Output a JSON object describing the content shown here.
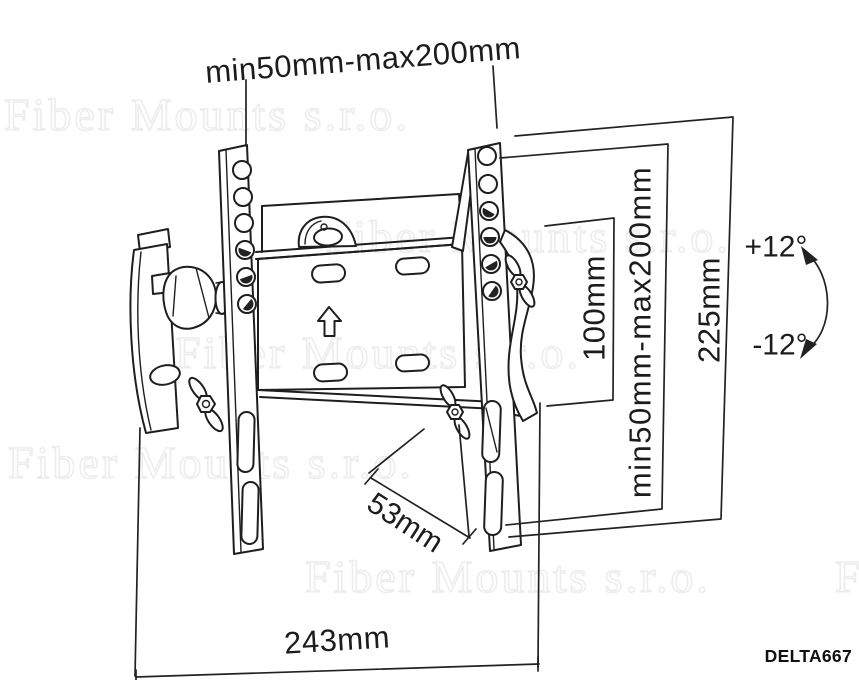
{
  "meta": {
    "type": "technical-line-drawing",
    "subject": "Tilting TV wall mount bracket, three-quarter view with dimension callouts"
  },
  "colors": {
    "background": "#ffffff",
    "line": "#1e1e1e",
    "dimension_text": "#1c1c1c",
    "watermark": "#ededed"
  },
  "watermark": {
    "text": "Fiber Mounts s.r.o."
  },
  "labels": {
    "top_span": "min50mm-max200mm",
    "inner_height": "100mm",
    "side_height_range": "min50mm-max200mm",
    "overall_height": "225mm",
    "tilt_up": "+12°",
    "tilt_down": "-12°",
    "depth": "53mm",
    "overall_width": "243mm",
    "model": "DELTA667"
  }
}
